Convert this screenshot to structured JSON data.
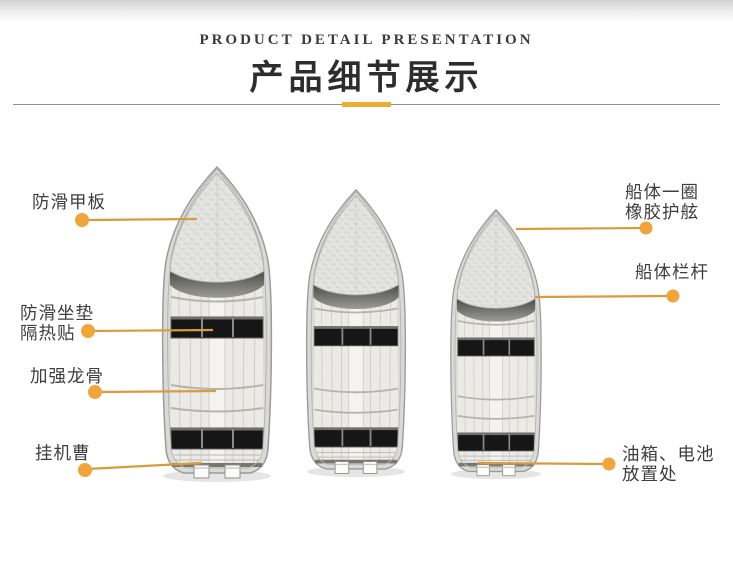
{
  "header": {
    "subtitle": "PRODUCT DETAIL PRESENTATION",
    "title": "产品细节展示"
  },
  "theme": {
    "accent_gold": "#e9ae33",
    "leader_line_color": "#d89b3e",
    "dot_color": "#f0a53c",
    "label_text_color": "#3e3e3e",
    "title_color": "#2d2d2d",
    "divider_color": "#8f8f8f",
    "boat_hull_color": "#d9dad8",
    "bench_color": "#161616"
  },
  "boats": [
    {
      "id": "boat-large"
    },
    {
      "id": "boat-medium"
    },
    {
      "id": "boat-small"
    }
  ],
  "callouts": {
    "left": [
      {
        "lines": [
          "防滑甲板"
        ]
      },
      {
        "lines": [
          "防滑坐垫",
          "隔热贴"
        ]
      },
      {
        "lines": [
          "加强龙骨"
        ]
      },
      {
        "lines": [
          "挂机曹"
        ]
      }
    ],
    "right": [
      {
        "lines": [
          "船体一圈",
          "橡胶护舷"
        ]
      },
      {
        "lines": [
          "船体栏杆"
        ]
      },
      {
        "lines": [
          "油箱、电池",
          "放置处"
        ]
      }
    ]
  }
}
